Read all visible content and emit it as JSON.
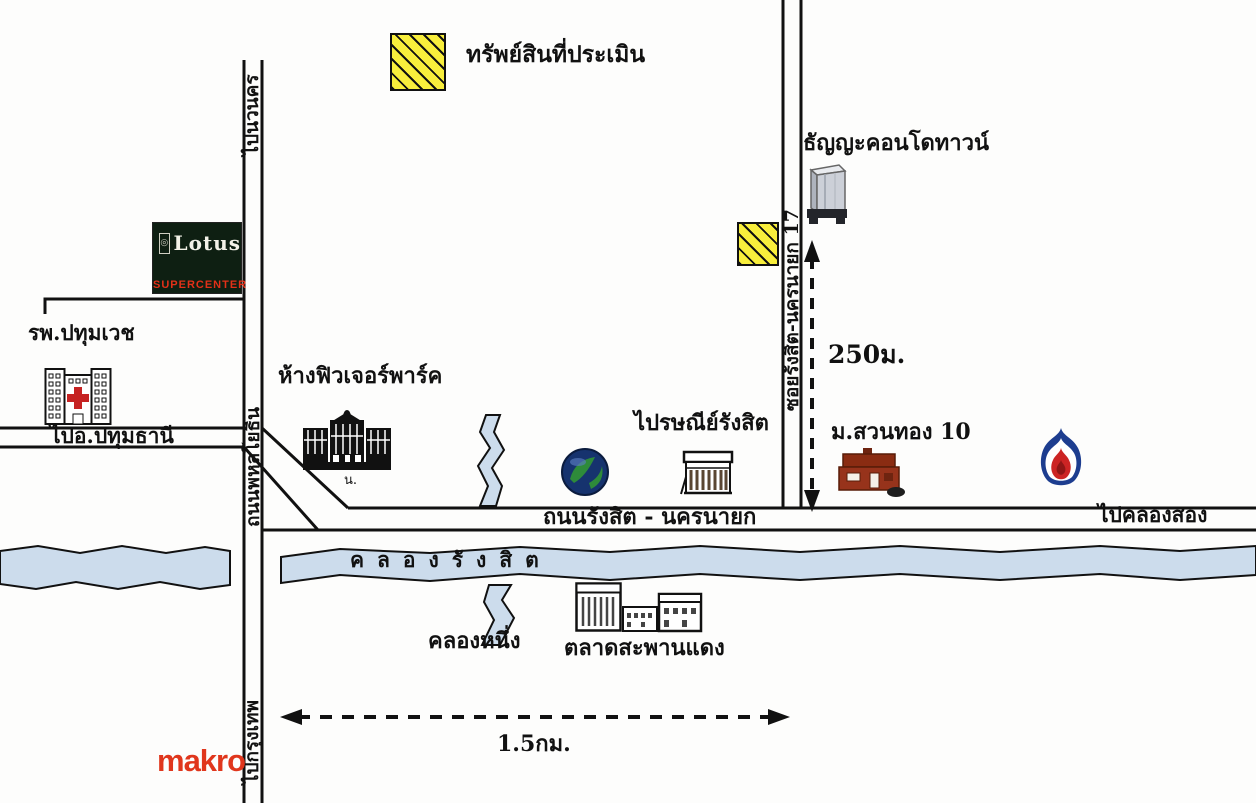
{
  "legend": {
    "property_label": "ทรัพย์สินที่ประเมิน"
  },
  "labels": {
    "to_nava_nakhon": "ไปนวนคร",
    "hospital": "รพ.ปทุมเวช",
    "to_pathum_thani": "ไปอ.ปทุมธานี",
    "phahonyothin_road": "ถนนพหลโยธิน",
    "future_park": "ห้างฟิวเจอร์พาร์ค",
    "future_park_note": "น.",
    "condo": "ธัญญะคอนโดทาวน์",
    "soi_17": "ซอยรังสิต-นครนายก 17",
    "distance_250m": "250ม.",
    "post_office": "ไปรษณีย์รังสิต",
    "suan_thong": "ม.สวนทอง 10",
    "main_road": "ถนนรังสิต - นครนายก",
    "to_khlong_song": "ไปคลองสอง",
    "khlong_rangsit": "คลองรังสิต",
    "khlong_nueng": "คลองหนึ่ง",
    "market": "ตลาดสะพานแดง",
    "distance_1_5km": "1.5กม.",
    "to_bangkok": "ไปกรุงเทพ"
  },
  "logos": {
    "lotus_name": "Lotus",
    "lotus_sub": "SUPERCENTER",
    "lotus_mark": "◎",
    "makro": "makro"
  },
  "colors": {
    "property_fill": "#f8ee3c",
    "canal_fill": "#ccdcec",
    "road_stroke": "#111111",
    "makro_red": "#e0361c",
    "ptt_blue": "#1d3d8f",
    "ptt_red": "#cc2424",
    "suan_thong_red": "#8a2c12",
    "hospital_cross_red": "#c62222"
  }
}
